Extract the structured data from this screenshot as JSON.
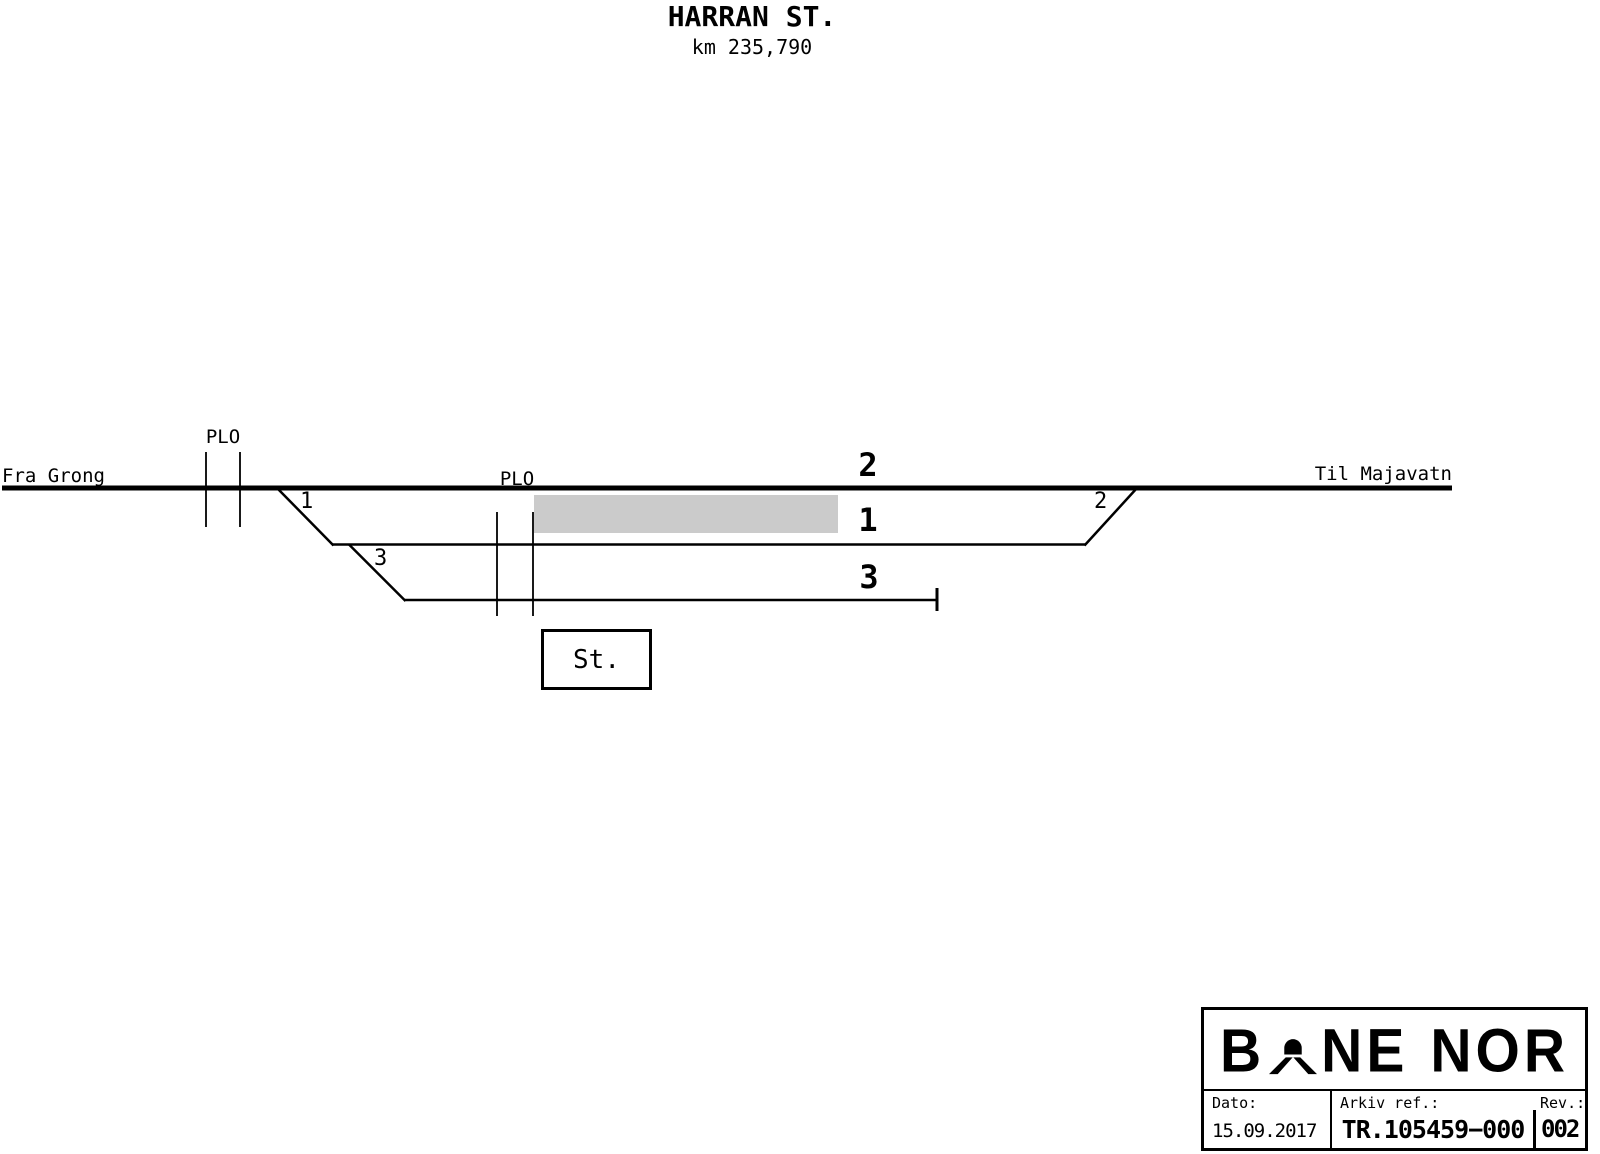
{
  "title": {
    "station": "HARRAN ST.",
    "km": "km 235,790"
  },
  "diagram": {
    "from_label": "Fra Grong",
    "to_label": "Til Majavatn",
    "plo1_label": "PLO",
    "plo2_label": "PLO",
    "track_numbers": {
      "track2": "2",
      "track1": "1",
      "track3": "3"
    },
    "switch_numbers": {
      "switch1": "1",
      "switch3": "3",
      "switch2": "2"
    },
    "station_box_label": "St.",
    "platform_color": "#cbcbcb",
    "line_color": "#000000"
  },
  "title_block": {
    "logo_b": "B",
    "logo_ne": "NE",
    "logo_nor": "NOR",
    "dato_label": "Dato:",
    "dato_value": "15.09.2017",
    "arkiv_label": "Arkiv ref.:",
    "arkiv_value": "TR.105459−000",
    "rev_label": "Rev.:",
    "rev_value": "002"
  }
}
